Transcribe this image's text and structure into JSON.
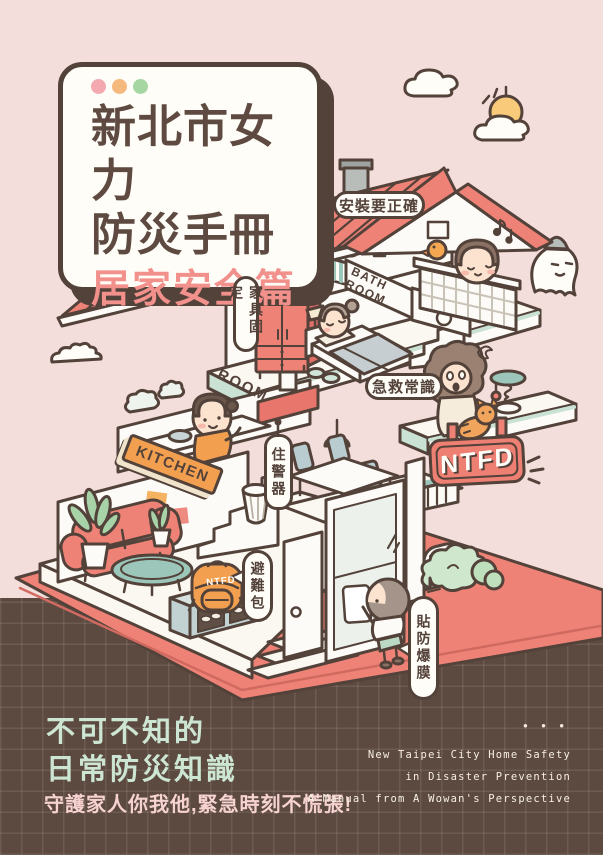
{
  "title_card": {
    "window_dots": [
      "#f4a9b1",
      "#f5b97e",
      "#a6d7a2"
    ],
    "title_line1": "新北市女力",
    "title_line2": "防災手冊",
    "subtitle": "居家安全篇"
  },
  "labels": {
    "install": "安裝要正確",
    "furniture": "家具固定",
    "bath_line1": "BATH",
    "bath_line2": "ROOM",
    "room": "ROOM",
    "first_aid": "急救常識",
    "kitchen": "KITCHEN",
    "alarm": "住警器",
    "ntfd_sign": "NTFD",
    "backpack": "NTFD",
    "evacuation_bag": "避難包",
    "blast_film": "貼防爆膜"
  },
  "footer": {
    "headline_line1": "不可不知的",
    "headline_line2": "日常防災知識",
    "tagline": "守護家人你我他,緊急時刻不慌張!",
    "dots": "• • •",
    "english_line1": "New Taipei City Home Safety",
    "english_line2": "in Disaster Prevention",
    "english_line3": "A Manual from A Wowan's Perspective"
  },
  "colors": {
    "background_pink": "#f4dedc",
    "background_brown": "#5c4a40",
    "accent_salmon": "#ee8276",
    "accent_orange": "#f2a050",
    "mint": "#cde6d3",
    "outline": "#53423a"
  }
}
